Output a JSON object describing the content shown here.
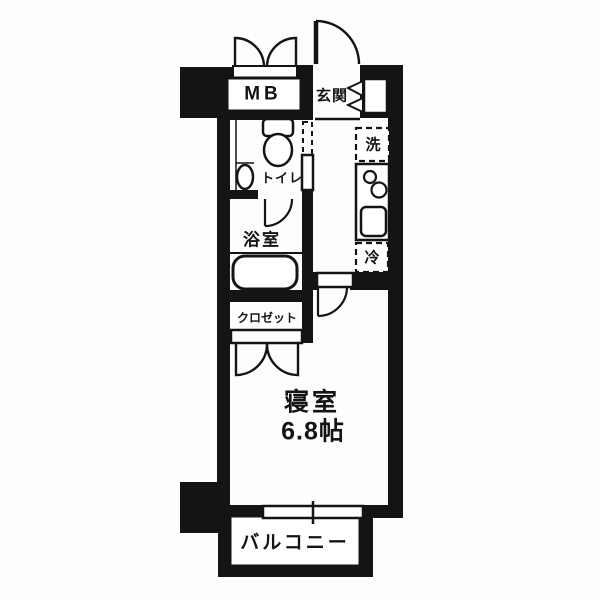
{
  "title": "apartment-floor-plan",
  "colors": {
    "wall": "#141414",
    "floor": "#ffffff",
    "background": "#fdfdfd",
    "line": "#141414"
  },
  "rooms": {
    "meter_box": {
      "label": "MB"
    },
    "entrance": {
      "label": "玄関"
    },
    "toilet": {
      "label": "トイレ"
    },
    "washer": {
      "label": "洗"
    },
    "fridge": {
      "label": "冷"
    },
    "bath": {
      "label": "浴室"
    },
    "closet": {
      "label": "クロゼット"
    },
    "bedroom": {
      "label": "寝室",
      "size": "6.8帖"
    },
    "balcony": {
      "label": "バルコニー"
    }
  },
  "icons": [
    "double-swing-door-icon",
    "entry-door-arc-icon",
    "folding-door-icon",
    "toilet-icon",
    "hand-basin-icon",
    "bathtub-icon",
    "stove-burners-icon",
    "kitchen-sink-icon",
    "door-arc-icon",
    "sliding-window-icon"
  ]
}
